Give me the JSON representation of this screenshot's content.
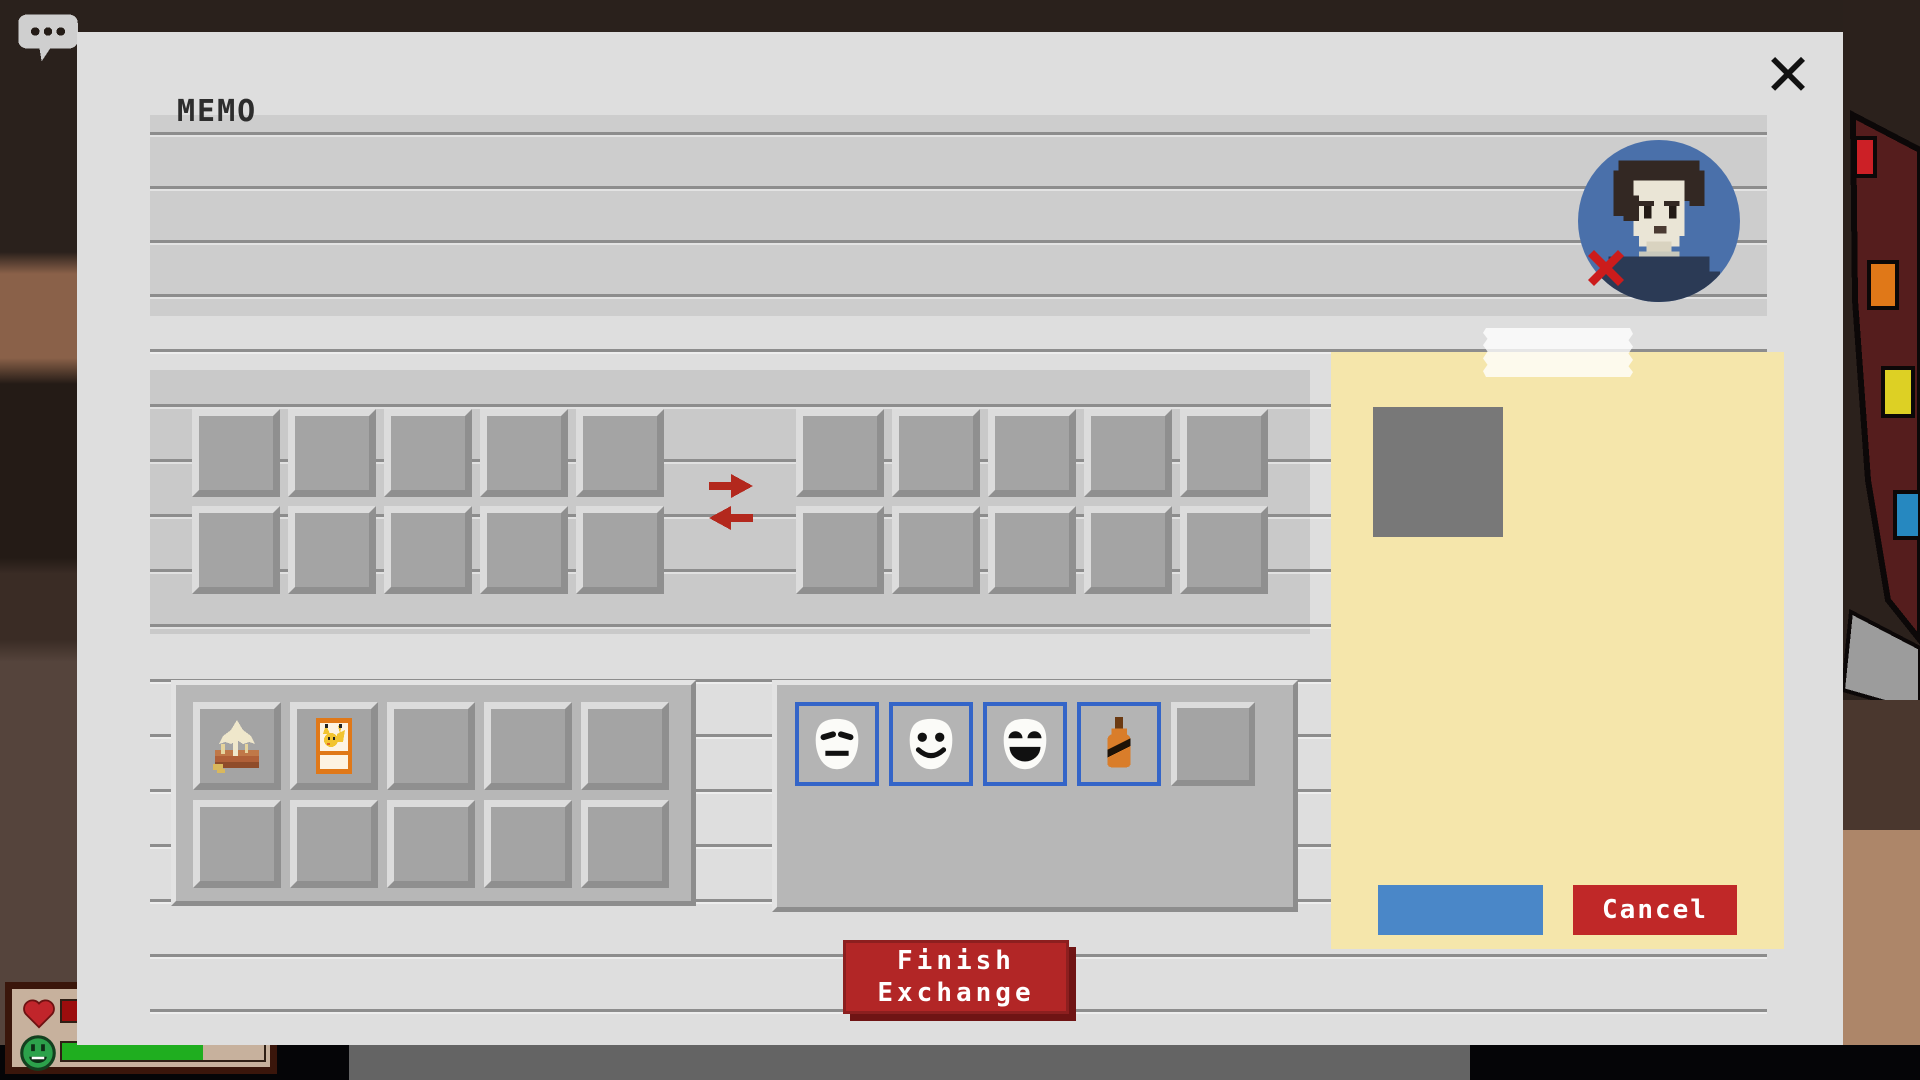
{
  "window": {
    "close_label": "✕"
  },
  "memo": {
    "title": "MEMO"
  },
  "partner": {
    "avatar_icon": "pixel-person",
    "status_icon": "red-x-declined",
    "avatar_bg": "#4a70aa"
  },
  "trade": {
    "arrow_icons": [
      "arrow-right",
      "arrow-left"
    ],
    "finish_line1": "Finish",
    "finish_line2": "Exchange"
  },
  "inventory": {
    "items": [
      {
        "name": "honey-toast"
      },
      {
        "name": "creature-card"
      }
    ]
  },
  "emotes": {
    "items": [
      {
        "name": "neutral-mask"
      },
      {
        "name": "smile-mask"
      },
      {
        "name": "laugh-mask"
      },
      {
        "name": "orange-marker"
      }
    ]
  },
  "note": {
    "confirm_label": "",
    "cancel_label": "Cancel",
    "background": "#f5e6ab",
    "confirm_color": "#4a87c8",
    "cancel_color": "#c02828"
  },
  "hud": {
    "health_icon": "heart",
    "mood_icon": "green-smiley",
    "mood_fill_percent": 70
  },
  "colors": {
    "dialog_bg": "#dedede",
    "slot_accent_blue": "#3465c8",
    "button_red": "#b22626"
  }
}
